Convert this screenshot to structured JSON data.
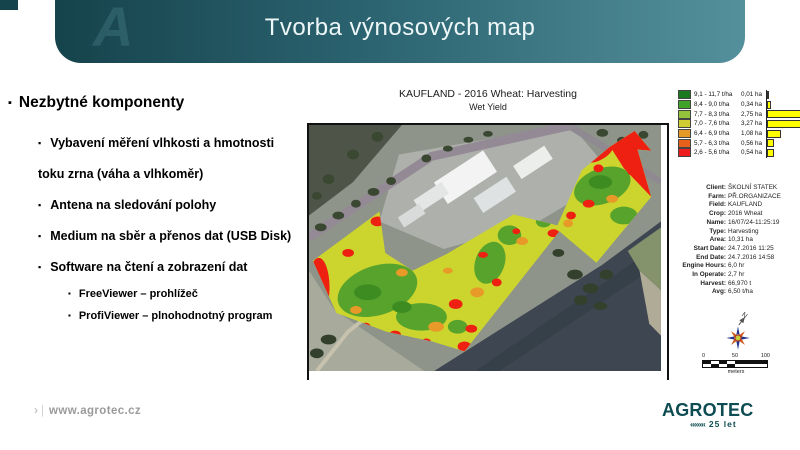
{
  "header": {
    "title": "Tvorba výnosových map",
    "watermark": "A"
  },
  "content": {
    "heading": "Nezbytné komponenty",
    "bullet_glyph": "▪",
    "bullets": [
      {
        "text": "Vybavení měření vlhkosti a hmotnosti\ntoku zrna (váha a vlhkoměr)"
      },
      {
        "text": "Antena na sledování polohy"
      },
      {
        "text": "Medium na sběr a přenos dat (USB Disk)"
      },
      {
        "text": "Software na čtení a zobrazení dat"
      }
    ],
    "sub_bullets": [
      {
        "text": "FreeViewer – prohlížeč"
      },
      {
        "text": "ProfiViewer – plnohodnotný program"
      }
    ]
  },
  "map": {
    "title": "KAUFLAND - 2016 Wheat: Harvesting",
    "subtitle": "Wet Yield",
    "legend_bar_color": "#ffff00",
    "legend": [
      {
        "range": "9,1 - 11,7 t/ha",
        "area": "0,01 ha",
        "value": 0.01,
        "color": "#1c7a1e"
      },
      {
        "range": "8,4 - 9,0 t/ha",
        "area": "0,34 ha",
        "value": 0.34,
        "color": "#3fa32a"
      },
      {
        "range": "7,7 - 8,3 t/ha",
        "area": "2,75 ha",
        "value": 2.75,
        "color": "#92c33a"
      },
      {
        "range": "7,0 - 7,6 t/ha",
        "area": "3,27 ha",
        "value": 3.27,
        "color": "#d0cd32"
      },
      {
        "range": "6,4 - 6,9 t/ha",
        "area": "1,08 ha",
        "value": 1.08,
        "color": "#e59a28"
      },
      {
        "range": "5,7 - 6,3 t/ha",
        "area": "0,56 ha",
        "value": 0.56,
        "color": "#e8611c"
      },
      {
        "range": "2,6 - 5,6 t/ha",
        "area": "0,54 ha",
        "value": 0.54,
        "color": "#ee1c1c"
      }
    ],
    "info": [
      {
        "label": "Client:",
        "value": "ŠKOLNÍ STATEK"
      },
      {
        "label": "Farm:",
        "value": "PŘ.ORGANIZACE"
      },
      {
        "label": "Field:",
        "value": "KAUFLAND"
      },
      {
        "label": "Crop:",
        "value": "2016 Wheat"
      },
      {
        "label": "Name:",
        "value": "16/07/24-11:25:19"
      },
      {
        "label": "Type:",
        "value": "Harvesting"
      },
      {
        "label": "Area:",
        "value": "10,31 ha"
      },
      {
        "label": "Start Date:",
        "value": "24.7.2016 11:25"
      },
      {
        "label": "End Date:",
        "value": "24.7.2016 14:58"
      },
      {
        "label": "Engine Hours:",
        "value": "6,0 hr"
      },
      {
        "label": "In Operate:",
        "value": "2,7 hr"
      },
      {
        "label": "Harvest:",
        "value": "66,970 t"
      },
      {
        "label": "Avg:",
        "value": "6,50 t/ha"
      }
    ],
    "compass_label": "N",
    "scale": {
      "tick0": "0",
      "tick50": "50",
      "tick100": "100",
      "unit": "meters"
    }
  },
  "footer": {
    "arrow": "›",
    "separator": "|",
    "url": "www.agrotec.cz"
  },
  "brand": {
    "name": "AGROTEC",
    "chevrons": "««««",
    "anniversary": "25 let"
  }
}
